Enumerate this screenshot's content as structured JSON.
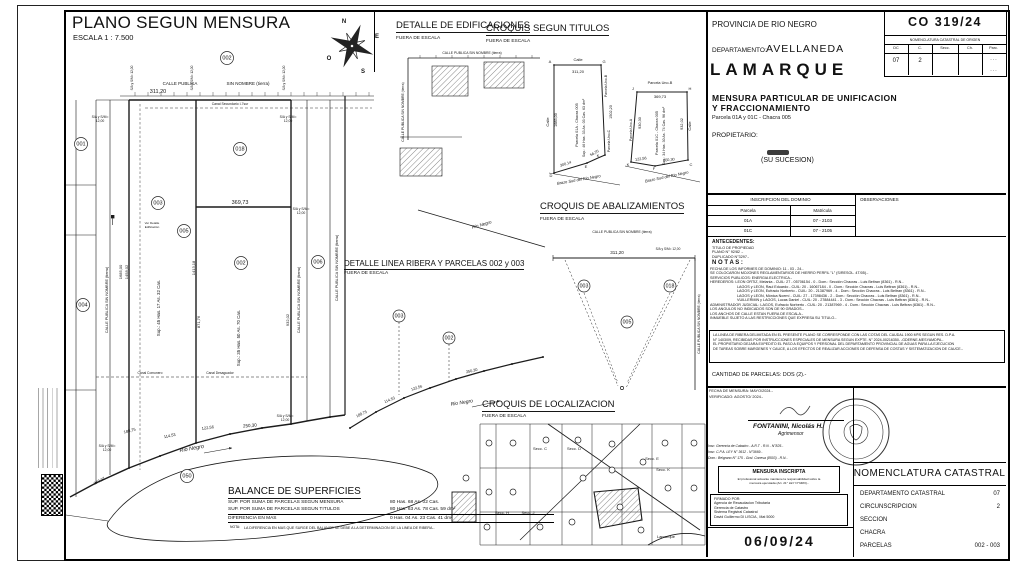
{
  "plan_title": {
    "title": "PLANO SEGUN MENSURA",
    "scale": "ESCALA 1 : 7.500"
  },
  "panels": {
    "edificaciones": {
      "title": "DETALLE DE EDIFICACIONES",
      "sub": "FUERA DE ESCALA"
    },
    "titulos": {
      "title": "CROQUIS SEGUN TITULOS",
      "sub": "FUERA DE ESCALA"
    },
    "abalizamientos": {
      "title": "CROQUIS DE ABALIZAMIENTOS",
      "sub": "FUERA DE ESCALA"
    },
    "ribera": {
      "title": "DETALLE LINEA RIBERA Y PARCELAS 002 y 003",
      "sub": "FUERA DE ESCALA"
    },
    "localizacion": {
      "title": "CROQUIS DE LOCALIZACION",
      "sub": "FUERA DE ESCALA"
    }
  },
  "balance": {
    "title": "BALANCE DE SUPERFICIES",
    "rows": [
      {
        "label": "SUP. POR SUMA DE PARCELAS SEGUN MENSURA",
        "value": "80 Has. 68 As. 02 Cas."
      },
      {
        "label": "SUP. POR SUMA DE PARCELAS SEGUN TITULOS",
        "value": "80 Has. 63 As. 78 Cas. 59 dm²"
      },
      {
        "label": "DIFERENCIA EN MAS",
        "value": "0 Has. 04 As. 23 Cas. 41 dm²"
      }
    ],
    "nota_label": "NOTA:",
    "nota": "LA DIFERENCIA EN MAS QUE SURGE DEL BALANCE SE DEBE A LA DETERMINACION DE LA LINEA DE RIBERA.-"
  },
  "right": {
    "provincia": "PROVINCIA DE RIO NEGRO",
    "plan_no": "CO  319/24",
    "origin": {
      "title": "NOMENCLATURA CATASTRAL DE ORIGEN",
      "cols": [
        "DC",
        "C.",
        "Secc.",
        "Ch.",
        "Parc."
      ],
      "dc": "07",
      "c": "2",
      "dots": "- - -"
    },
    "dept_label": "DEPARTAMENTO:",
    "dept": "AVELLANEDA",
    "city": "LAMARQUE",
    "op1": "MENSURA PARTICULAR DE UNIFICACION",
    "op2": "Y FRACCIONAMIENTO",
    "parcela_line": "Parcela 01A y 01C - Chacra 005",
    "owner_label": "PROPIETARIO:",
    "owner_sucesion": "(SU SUCESION)",
    "dominio": {
      "title": "INSCRIPCION DEL DOMINIO",
      "obs": "OBSERVACIONES",
      "col1": "Parcela",
      "col2": "Matricula",
      "rows": [
        {
          "p": "01A",
          "m": "07 - 2103"
        },
        {
          "p": "01C",
          "m": "07 - 2105"
        }
      ]
    },
    "antecedentes": {
      "title": "ANTECEDENTES:",
      "lines": [
        "TITULO DE PROPIEDAD",
        "PLANO N° 92/82 .-",
        "DUPLICADO N°3297.-"
      ]
    },
    "notas": {
      "title": "N O T A S :",
      "lines": [
        "FECHA DE LOS INFORMES DE DOMINIO: 11 - 03 - 24.-",
        "SE COLOCARON MOJONES REGLAMENTARIOS DE HIERRO PERFIL \"L\" (S/RESOL. 4T/05).-",
        "SERVICIOS PUBLICOS: ENERGIA ELECTRICA.-",
        "HEREDEROS: LEON ORTIZ, Melania - CUIL: 27 - 05706154 - 0 - Dom.: Sección Chacras - Luis Beltran (8361) - R.N.-",
        "LAGOS y LEON, Raul Eduardo - CUIL: 20 - 16067184 - 0 - Dom.: Sección Chacras - Luis Beltran (8361) - R.N.-",
        "LAGOS y LEON, Eufracio Norberto - CUIL: 20 - 21387969 - 4 - Dom.: Sección Chacras - Luis Beltran (8361) - R.N.-",
        "LAGOS y LEON, Mónica Noemí - CUIL: 27 - 17398436 - 2 - Dom.: Sección Chacras - Luis Beltran (8361) - R.N.-",
        "VUILLERMIN y LAGOS, Lucas Daniel - CUIL: 20 - 27884441 - 3 - Dom.: Sección Chacras - Luis Beltran (8361) - R.N.-",
        "ADMINISTRADOR JUDICIAL: LAGOS, Eufracio Norberto - CUIL: 20 - 21387969 - 4 - Dom.: Sección Chacras - Luis Beltran (8361) - R.N.-",
        "LOS ANGULOS NO INDICADOS SON DE 90 GRADOS.-",
        "LOS ANCHOS DE CALLE ESTAN FUERA DE ESCALA.-",
        "INMUEBLE SUJETO A LAS RESTRICCIONES QUE EXPRESA SU TITULO.-"
      ]
    },
    "ribera_box": {
      "lines": [
        "LA LINEA DE RIBERA DELIMITADA EN EL PRESENTE PLANO SE CORRESPONDE CON LAS COTAS DEL CAUDAL 1900 M³/S SEGUN RES. D.P.A.",
        "N° 1403/09, RECIBIDAS POR INSTRUCCIONES ESPECIALES DE MENSURA SEGUN EXPTE. N° 2024-00216350- -GDERNE-MESYAMDPA.-",
        "EL PROPIETARIO DEJARA EXPEDITO EL PASO A EQUIPOS Y PERSONAL DEL DEPARTAMENTO PROVINCIAL DE AGUAS PARA LA EJECUCION",
        "DE TAREAS SOBRE MARGENES Y CAUCE, A LOS EFECTOS DE REALIZAR ACCIONES DE DEFENSA DE COSTAS Y SISTEMATIZACION DE CAUCE.-"
      ]
    },
    "cantidad": "CANTIDAD DE PARCELAS:  DOS (2).-",
    "fecha": [
      "FECHA DE MENSURA: MAYO/2024.-",
      "VERIFICADO: AGOSTO/ 2024.-"
    ],
    "surveyor": {
      "name": "FONTANINI, Nicolás H.",
      "title": "Agrimensor",
      "lines": [
        "Insc: Gerencia de Catastro - A.R.T - R.N - N°825.-",
        "Insc: C.P.A. LEY N° 3612 - N°3669.-",
        "Dom.: Belgrano N° 175 - Gral. Conesa (8503) - R.N.-"
      ]
    },
    "inscripta": {
      "title": "MENSURA INSCRIPTA",
      "lines": [
        "El profesional actuante mantiene la responsabilidad sobre la",
        "mensura ejecutada (Art. 21° LEY N°3483).-"
      ]
    },
    "firmado": {
      "lines": [
        "FIRMADO POR:",
        "Agencia de Recaudacion Tributaria",
        "Gerencia de Catastro",
        "Sistema Registral Catastral",
        "David Guillermo DI LISCIA , Mat 5000"
      ]
    },
    "date_box": "06/09/24",
    "nomenclatura": {
      "title": "NOMENCLATURA CATASTRAL",
      "rows": [
        {
          "l": "DEPARTAMENTO CATASTRAL",
          "v": "07"
        },
        {
          "l": "CIRCUNSCRIPCION",
          "v": "2"
        },
        {
          "l": "SECCION",
          "v": ""
        },
        {
          "l": "CHACRA",
          "v": ""
        },
        {
          "l": "PARCELAS",
          "v": "002 - 003"
        }
      ]
    }
  },
  "svg": {
    "labels": {
      "plan": [
        {
          "t": "CALLE PUBLICA",
          "x": 180,
          "y": 85,
          "s": 4.5
        },
        {
          "t": "SIN NOMBRE (tierra)",
          "x": 248,
          "y": 85,
          "s": 4.5
        },
        {
          "t": "311,20",
          "x": 158,
          "y": 93,
          "s": 5.5
        },
        {
          "t": "369,73",
          "x": 240,
          "y": 204,
          "s": 5.5
        },
        {
          "t": "S/A y S/M=",
          "x": 100,
          "y": 118,
          "s": 3.4
        },
        {
          "t": "12,00",
          "x": 100,
          "y": 122,
          "s": 3.4
        },
        {
          "t": "S/A y S/M=",
          "x": 288,
          "y": 118,
          "s": 3.4
        },
        {
          "t": "12,00",
          "x": 288,
          "y": 122,
          "s": 3.4
        },
        {
          "t": "S/A y S/M=",
          "x": 301,
          "y": 210,
          "s": 3.4
        },
        {
          "t": "12,00",
          "x": 301,
          "y": 214,
          "s": 3.4
        },
        {
          "t": "S/A y S/M=",
          "x": 107,
          "y": 447,
          "s": 3.4
        },
        {
          "t": "12,00",
          "x": 107,
          "y": 451,
          "s": 3.4
        },
        {
          "t": "S/A y S/M=",
          "x": 285,
          "y": 417,
          "s": 3.4
        },
        {
          "t": "12,00",
          "x": 285,
          "y": 421,
          "s": 3.4
        },
        {
          "t": "S/A y S/M= 12,00",
          "x": 133,
          "y": 78,
          "r": -90,
          "s": 3.2
        },
        {
          "t": "S/A y S/M= 12,00",
          "x": 193,
          "y": 78,
          "r": -90,
          "s": 3.2
        },
        {
          "t": "S/A y S/M= 12,00",
          "x": 285,
          "y": 78,
          "r": -90,
          "s": 3.2
        },
        {
          "t": "Canal Secundario I-7sur",
          "x": 230,
          "y": 105,
          "s": 3.4
        },
        {
          "t": "Canal Comunero",
          "x": 150,
          "y": 374,
          "s": 3.3
        },
        {
          "t": "Canal Desaguador",
          "x": 220,
          "y": 374,
          "s": 3.3
        },
        {
          "t": "1685,00",
          "x": 122,
          "y": 272,
          "r": -90,
          "s": 4
        },
        {
          "t": "1458,02",
          "x": 128,
          "y": 272,
          "r": -90,
          "s": 4
        },
        {
          "t": "1413,18",
          "x": 195,
          "y": 268,
          "r": -90,
          "s": 4
        },
        {
          "t": "871,76",
          "x": 200,
          "y": 322,
          "r": -90,
          "s": 4
        },
        {
          "t": "932,02",
          "x": 289,
          "y": 320,
          "r": -90,
          "s": 4
        },
        {
          "t": "Sup.: 45 Has. 17 As. 32 Cas.",
          "x": 160,
          "y": 308,
          "r": -90,
          "s": 4.4
        },
        {
          "t": "Sup.: 35 Has. 50 As. 70 Cas.",
          "x": 240,
          "y": 338,
          "r": -90,
          "s": 4.4
        },
        {
          "t": "CALLE PUBLICA SIN NOMBRE (tierra)",
          "x": 108,
          "y": 300,
          "r": -90,
          "s": 3.8
        },
        {
          "t": "CALLE PUBLICA SIN NOMBRE (tierra)",
          "x": 300,
          "y": 300,
          "r": -90,
          "s": 3.8
        },
        {
          "t": "CALLE PUBLICA SIN NOMBRE (tierra)",
          "x": 338,
          "y": 268,
          "r": -90,
          "s": 3.8
        },
        {
          "t": "188,75",
          "x": 130,
          "y": 432,
          "r": -14,
          "s": 4
        },
        {
          "t": "114,53",
          "x": 170,
          "y": 437,
          "r": -12,
          "s": 4
        },
        {
          "t": "122,56",
          "x": 208,
          "y": 429,
          "r": -8,
          "s": 4
        },
        {
          "t": "250,30",
          "x": 250,
          "y": 427,
          "r": -5,
          "s": 4.5
        },
        {
          "t": "243,97",
          "x": 100,
          "y": 482,
          "r": -28,
          "s": 4
        },
        {
          "t": "Rio Negro",
          "x": 192,
          "y": 450,
          "r": -10,
          "s": 5.5,
          "i": 1
        },
        {
          "t": "Ver Detalle",
          "x": 152,
          "y": 224,
          "s": 3
        },
        {
          "t": "Edificación",
          "x": 152,
          "y": 228,
          "s": 3
        },
        {
          "t": "N",
          "x": 344,
          "y": 23,
          "s": 6,
          "b": 1
        },
        {
          "t": "E",
          "x": 377,
          "y": 38,
          "s": 6,
          "b": 1
        },
        {
          "t": "S",
          "x": 363,
          "y": 73,
          "s": 6,
          "b": 1
        },
        {
          "t": "O",
          "x": 329,
          "y": 60,
          "s": 6,
          "b": 1
        }
      ],
      "edif": [
        {
          "t": "CALLE PUBLICA SIN NOMBRE (tierra)",
          "x": 472,
          "y": 54,
          "s": 3.4
        },
        {
          "t": "CALLE PUBLICA SIN NOMBRE (tierra)",
          "x": 404,
          "y": 112,
          "r": -90,
          "s": 3.4
        },
        {
          "t": "Rio Negro",
          "x": 482,
          "y": 226,
          "r": -16,
          "s": 4.5,
          "i": 1
        }
      ],
      "titulos": [
        {
          "t": "Calle",
          "x": 578,
          "y": 61,
          "s": 4
        },
        {
          "t": "A",
          "x": 550,
          "y": 63,
          "s": 4
        },
        {
          "t": "G",
          "x": 604,
          "y": 63,
          "s": 4
        },
        {
          "t": "311,20",
          "x": 578,
          "y": 73,
          "s": 4
        },
        {
          "t": "Calle",
          "x": 549,
          "y": 122,
          "r": -90,
          "s": 4
        },
        {
          "t": "1685,00",
          "x": 557,
          "y": 120,
          "r": -90,
          "s": 3.8
        },
        {
          "t": "Parcela Uno-B",
          "x": 607,
          "y": 86,
          "r": -90,
          "s": 3.4
        },
        {
          "t": "1502,20",
          "x": 612,
          "y": 112,
          "r": -90,
          "s": 3.8
        },
        {
          "t": "Parcela Uno-C",
          "x": 610,
          "y": 141,
          "r": -90,
          "s": 3.4
        },
        {
          "t": "Parcela 01A - Chacra 005",
          "x": 578,
          "y": 125,
          "r": -90,
          "s": 3.8
        },
        {
          "t": "Sup.: 46 Has. 33 As. 03 Cas. 63 dm²",
          "x": 585,
          "y": 128,
          "r": -90,
          "s": 3.6
        },
        {
          "t": "300,14",
          "x": 566,
          "y": 165,
          "r": -18,
          "s": 3.8
        },
        {
          "t": "56,25",
          "x": 595,
          "y": 154,
          "r": -30,
          "s": 3.8
        },
        {
          "t": "Brazo Sud del Rio Negro",
          "x": 579,
          "y": 181,
          "r": -10,
          "s": 4,
          "i": 1
        },
        {
          "t": "D",
          "x": 551,
          "y": 177,
          "s": 4
        },
        {
          "t": "E",
          "x": 586,
          "y": 168,
          "s": 4
        },
        {
          "t": "K",
          "x": 598,
          "y": 157,
          "s": 4
        },
        {
          "t": "Parcela Uno-B",
          "x": 660,
          "y": 84,
          "s": 3.8
        },
        {
          "t": "J",
          "x": 633,
          "y": 90,
          "s": 4
        },
        {
          "t": "H",
          "x": 690,
          "y": 90,
          "s": 4
        },
        {
          "t": "369,73",
          "x": 660,
          "y": 98,
          "s": 4
        },
        {
          "t": "Parcela Uno-A",
          "x": 632,
          "y": 130,
          "r": -90,
          "s": 3.4
        },
        {
          "t": "930,30",
          "x": 641,
          "y": 123,
          "r": -90,
          "s": 3.8
        },
        {
          "t": "Calle",
          "x": 691,
          "y": 126,
          "r": -90,
          "s": 4
        },
        {
          "t": "932,02",
          "x": 683,
          "y": 124,
          "r": -90,
          "s": 3.8
        },
        {
          "t": "Parcela 01C - Chacra 005",
          "x": 658,
          "y": 133,
          "r": -90,
          "s": 3.8
        },
        {
          "t": "Sup.: 34 Has. 30 As. 74 Cas. 96 dm²",
          "x": 665,
          "y": 136,
          "r": -90,
          "s": 3.6
        },
        {
          "t": "122,56",
          "x": 641,
          "y": 160,
          "r": -8,
          "s": 3.8
        },
        {
          "t": "250,30",
          "x": 669,
          "y": 161,
          "r": -6,
          "s": 3.8
        },
        {
          "t": "Brazo Sud del Rio Negro",
          "x": 667,
          "y": 178,
          "r": -12,
          "s": 4,
          "i": 1
        },
        {
          "t": "K",
          "x": 628,
          "y": 166,
          "s": 4
        },
        {
          "t": "F",
          "x": 654,
          "y": 170,
          "s": 4
        },
        {
          "t": "C",
          "x": 691,
          "y": 166,
          "s": 4
        }
      ],
      "abaliz": [
        {
          "t": "CALLE PUBLICA SIN NOMBRE (tierra)",
          "x": 622,
          "y": 233,
          "s": 3.4
        },
        {
          "t": "311,20",
          "x": 617,
          "y": 254,
          "s": 4.5
        },
        {
          "t": "S/A y S/M= 12,00",
          "x": 668,
          "y": 250,
          "s": 3.2
        },
        {
          "t": "CALLE PUBLICA SIN NOMBRE (tierra)",
          "x": 700,
          "y": 324,
          "r": -90,
          "s": 3.4
        }
      ],
      "ribera": [
        {
          "t": "188,75",
          "x": 362,
          "y": 415,
          "r": -25,
          "s": 3.8
        },
        {
          "t": "114,53",
          "x": 390,
          "y": 401,
          "r": -22,
          "s": 3.8
        },
        {
          "t": "122,56",
          "x": 417,
          "y": 389,
          "r": -18,
          "s": 3.8
        },
        {
          "t": "250,30",
          "x": 472,
          "y": 372,
          "r": -13,
          "s": 3.8
        },
        {
          "t": "Rio Negro",
          "x": 462,
          "y": 404,
          "r": -9,
          "s": 5,
          "i": 1
        }
      ],
      "localiz": [
        {
          "t": "Secc. C",
          "x": 540,
          "y": 450,
          "s": 4
        },
        {
          "t": "Secc. D",
          "x": 574,
          "y": 450,
          "s": 4
        },
        {
          "t": "Secc. E",
          "x": 652,
          "y": 460,
          "s": 4
        },
        {
          "t": "Secc. K",
          "x": 663,
          "y": 471,
          "s": 4
        },
        {
          "t": "Secc. H",
          "x": 502,
          "y": 514,
          "s": 4
        },
        {
          "t": "Secc. J",
          "x": 528,
          "y": 514,
          "s": 4
        },
        {
          "t": "Lamarque",
          "x": 666,
          "y": 538,
          "s": 4
        }
      ]
    },
    "circles": {
      "plan": [
        {
          "t": "001",
          "x": 81,
          "y": 144
        },
        {
          "t": "002",
          "x": 227,
          "y": 58
        },
        {
          "t": "018",
          "x": 240,
          "y": 149
        },
        {
          "t": "003",
          "x": 158,
          "y": 203
        },
        {
          "t": "005",
          "x": 184,
          "y": 231
        },
        {
          "t": "002",
          "x": 241,
          "y": 263
        },
        {
          "t": "004",
          "x": 83,
          "y": 305
        },
        {
          "t": "006",
          "x": 318,
          "y": 262
        },
        {
          "t": "050",
          "x": 187,
          "y": 476
        }
      ],
      "abaliz": [
        {
          "t": "003",
          "x": 584,
          "y": 286,
          "rr": 6
        },
        {
          "t": "018",
          "x": 670,
          "y": 286,
          "rr": 6
        },
        {
          "t": "005",
          "x": 627,
          "y": 322,
          "rr": 6
        }
      ],
      "ribera": [
        {
          "t": "003",
          "x": 399,
          "y": 316,
          "rr": 6
        },
        {
          "t": "002",
          "x": 449,
          "y": 338,
          "rr": 6
        }
      ],
      "localiz": [
        {
          "x": 489,
          "y": 443,
          "rr": 3
        },
        {
          "x": 513,
          "y": 443,
          "rr": 3
        },
        {
          "x": 546,
          "y": 440,
          "rr": 3
        },
        {
          "x": 578,
          "y": 440,
          "rr": 3
        },
        {
          "x": 612,
          "y": 444,
          "rr": 3
        },
        {
          "x": 665,
          "y": 443,
          "rr": 3
        },
        {
          "x": 694,
          "y": 443,
          "rr": 3
        },
        {
          "x": 466,
          "y": 478,
          "rr": 3
        },
        {
          "x": 489,
          "y": 492,
          "rr": 3
        },
        {
          "x": 513,
          "y": 492,
          "rr": 3
        },
        {
          "x": 583,
          "y": 478,
          "rr": 3
        },
        {
          "x": 612,
          "y": 470,
          "rr": 3
        },
        {
          "x": 643,
          "y": 462,
          "rr": 3
        },
        {
          "x": 668,
          "y": 488,
          "rr": 3
        },
        {
          "x": 694,
          "y": 488,
          "rr": 3
        },
        {
          "x": 540,
          "y": 527,
          "rr": 3
        },
        {
          "x": 572,
          "y": 522,
          "rr": 3
        },
        {
          "x": 641,
          "y": 530,
          "rr": 3
        },
        {
          "x": 487,
          "y": 527,
          "rr": 3
        },
        {
          "x": 620,
          "y": 507,
          "rr": 3
        }
      ]
    }
  }
}
